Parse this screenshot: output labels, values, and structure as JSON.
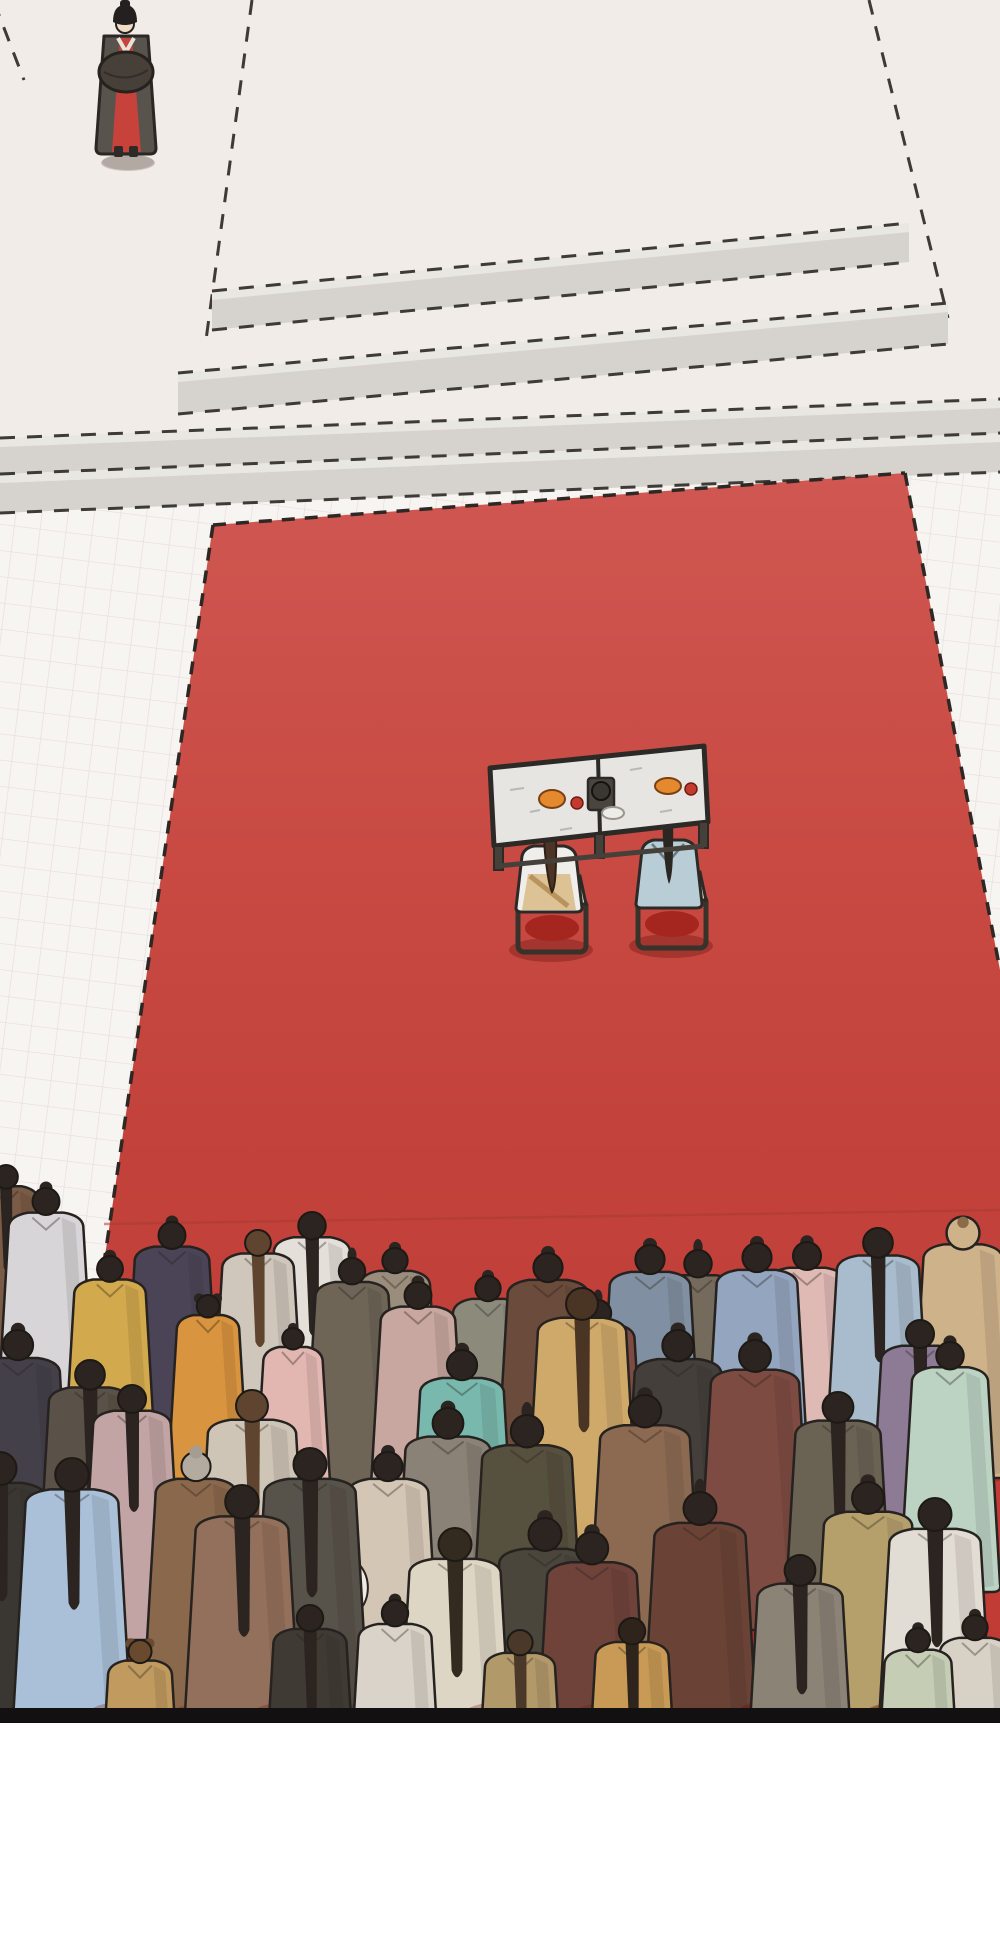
{
  "meta": {
    "type": "comic-panel",
    "description": "Overhead manhua scene: a court official in dark robe with red under-robe stands top-left beside a stepped stone dais; a long red ceremonial carpet runs down the hall to a table where two robed figures (cream and light blue) sit with dishes and a tea stand; a dense crowd of robed onlookers seen from behind fills the bottom; black panel border and white page margin below.",
    "text_content": "none"
  },
  "colors": {
    "page_bg": "#ffffff",
    "panel_border": "#121010",
    "floor_top": "#f1ece8",
    "floor_lower": "#f7f5f2",
    "tile_line": "#ded8d2",
    "step_face": "#d6d3ce",
    "step_light": "#e9e7e2",
    "dash": "#3e3a35",
    "carpet_top": "#d05752",
    "carpet_mid1": "#c84a43",
    "carpet_mid2": "#c2423b",
    "carpet_bottom": "#bf3a33",
    "carpet_edge_dash": "#2e2723",
    "carpet_shade_line": "#a93c34",
    "table_top": "#e7e5e1",
    "table_frame": "#45413a",
    "table_outline": "#2c2a26",
    "cushion": "#e9dec5",
    "seat_red": "#a5251f",
    "dish_orange": "#e5892f",
    "item_red": "#c23b2e",
    "plate": "#edece8",
    "kettle": "#3a3733",
    "bride_robe": "#f0eeea",
    "bride_sash": "#dcc294",
    "bride_strap": "#b9935c",
    "bride_hair": "#4c3526",
    "groom_robe": "#b9cdd6",
    "groom_hair": "#2c2622",
    "official_outer": "#59534d",
    "official_sleeve": "#474038",
    "official_red": "#c6423b",
    "official_hat": "#242020",
    "skin": "#f1dcc6",
    "hair_default": "#2b2420"
  },
  "scene": {
    "platform_edges": [
      "M252 0 L206 340",
      "M869 0 L948 318",
      "M-6 2 L24 80"
    ],
    "steps": [
      {
        "x1": 212,
        "y1": 300,
        "x2": 909,
        "y2": 232,
        "t": 30
      },
      {
        "x1": 178,
        "y1": 382,
        "x2": 948,
        "y2": 312,
        "t": 32
      },
      {
        "x1": 0,
        "y1": 447,
        "x2": 1000,
        "y2": 408,
        "t": 30
      },
      {
        "x1": 0,
        "y1": 483,
        "x2": 1000,
        "y2": 442,
        "t": 30
      }
    ],
    "carpet": {
      "points": "213,525 905,473 1000,970 1000,1723 36,1723",
      "border_paths": [
        "M213 525 L905 473",
        "M905 473 L1000 970",
        "M213 525 L36 1723"
      ],
      "shade_line": "M104 1224 L1000 1210"
    },
    "tile_shadows": [
      [
        128,
        163,
        27,
        8
      ],
      [
        20,
        1450,
        40,
        20
      ],
      [
        58,
        1530,
        58,
        26
      ],
      [
        30,
        1630,
        48,
        24
      ]
    ],
    "table_shadows": [
      [
        551,
        950,
        42,
        12
      ],
      [
        671,
        946,
        42,
        12
      ]
    ],
    "people": [
      {
        "x": 6,
        "y": 1165,
        "h": 215,
        "c": "#7a5b45",
        "s": "ponytail"
      },
      {
        "x": 46,
        "y": 1188,
        "h": 245,
        "c": "#d7d5d7",
        "s": "bun"
      },
      {
        "x": 172,
        "y": 1222,
        "h": 245,
        "c": "#4a4456",
        "s": "bun"
      },
      {
        "x": 110,
        "y": 1256,
        "h": 235,
        "c": "#d2a94c",
        "s": "bun"
      },
      {
        "x": 208,
        "y": 1295,
        "h": 205,
        "c": "#d8943e",
        "s": "doublebun"
      },
      {
        "x": 258,
        "y": 1230,
        "h": 235,
        "c": "#cfc7bc",
        "s": "ponytail",
        "hc": "#5f4530"
      },
      {
        "x": 312,
        "y": 1212,
        "h": 250,
        "c": "#e4dfd8",
        "s": "ponytail"
      },
      {
        "x": 293,
        "y": 1328,
        "h": 195,
        "c": "#e2b7b2",
        "s": "bun"
      },
      {
        "x": 352,
        "y": 1258,
        "h": 240,
        "c": "#6e6557",
        "s": "topknot"
      },
      {
        "x": 395,
        "y": 1248,
        "h": 230,
        "c": "#9a8d7c",
        "s": "bun"
      },
      {
        "x": 418,
        "y": 1282,
        "h": 245,
        "c": "#c7a79f",
        "s": "bun"
      },
      {
        "x": 488,
        "y": 1276,
        "h": 230,
        "c": "#8c8b7b",
        "s": "bun"
      },
      {
        "x": 548,
        "y": 1253,
        "h": 265,
        "c": "#6b4b3b",
        "s": "bun"
      },
      {
        "x": 598,
        "y": 1300,
        "h": 240,
        "c": "#7d4b42",
        "s": "topknot"
      },
      {
        "x": 650,
        "y": 1245,
        "h": 265,
        "c": "#8090a2",
        "s": "bun"
      },
      {
        "x": 698,
        "y": 1250,
        "h": 250,
        "c": "#746b5d",
        "s": "topknot"
      },
      {
        "x": 757,
        "y": 1243,
        "h": 265,
        "c": "#93a5bf",
        "s": "bun"
      },
      {
        "x": 807,
        "y": 1242,
        "h": 255,
        "c": "#dfb9b4",
        "s": "bun"
      },
      {
        "x": 878,
        "y": 1228,
        "h": 270,
        "c": "#a9bccd",
        "s": "ponytail"
      },
      {
        "x": 963,
        "y": 1218,
        "h": 260,
        "c": "#cdb28a",
        "s": "hood",
        "hc": "#8a6b4a"
      },
      {
        "x": 920,
        "y": 1320,
        "h": 255,
        "c": "#8d7a94",
        "s": "ponytail"
      },
      {
        "x": 950,
        "y": 1342,
        "h": 250,
        "c": "#bcd3c4",
        "s": "bun"
      },
      {
        "x": 18,
        "y": 1330,
        "h": 275,
        "c": "#43404a",
        "s": "bun",
        "b": 1
      },
      {
        "x": 90,
        "y": 1360,
        "h": 270,
        "c": "#5a5248",
        "s": "ponytail"
      },
      {
        "x": 132,
        "y": 1385,
        "h": 255,
        "c": "#c2a4a4",
        "s": "ponytail"
      },
      {
        "x": 196,
        "y": 1452,
        "h": 265,
        "c": "#8a684c",
        "s": "grayhair"
      },
      {
        "x": 252,
        "y": 1390,
        "h": 290,
        "c": "#cfc5b6",
        "s": "ponytail",
        "hc": "#5f4530"
      },
      {
        "x": 310,
        "y": 1448,
        "h": 300,
        "c": "#57524a",
        "s": "ponytail"
      },
      {
        "x": 388,
        "y": 1452,
        "h": 265,
        "c": "#d3c6b4",
        "s": "bun",
        "b": 1
      },
      {
        "x": 448,
        "y": 1408,
        "h": 280,
        "c": "#8a8276",
        "s": "bun"
      },
      {
        "x": 462,
        "y": 1350,
        "h": 275,
        "c": "#79b8ad",
        "s": "bun"
      },
      {
        "x": 527,
        "y": 1415,
        "h": 295,
        "c": "#56503f",
        "s": "topknot"
      },
      {
        "x": 582,
        "y": 1288,
        "h": 290,
        "c": "#cfa969",
        "s": "ponytail",
        "hc": "#4a3423"
      },
      {
        "x": 645,
        "y": 1395,
        "h": 295,
        "c": "#8c6a52",
        "s": "bun"
      },
      {
        "x": 678,
        "y": 1330,
        "h": 285,
        "c": "#443f3a",
        "s": "bun"
      },
      {
        "x": 755,
        "y": 1340,
        "h": 290,
        "c": "#7d4b42",
        "s": "bun"
      },
      {
        "x": 838,
        "y": 1392,
        "h": 280,
        "c": "#6a6354",
        "s": "ponytail"
      },
      {
        "x": 0,
        "y": 1452,
        "h": 300,
        "c": "#3a3733",
        "s": "ponytail"
      },
      {
        "x": 72,
        "y": 1458,
        "h": 305,
        "c": "#a9c0d8",
        "s": "ponytail"
      },
      {
        "x": 140,
        "y": 1640,
        "h": 210,
        "c": "#c09a5e",
        "s": "doublebun",
        "hc": "#6a4a2e"
      },
      {
        "x": 242,
        "y": 1485,
        "h": 305,
        "c": "#93705b",
        "s": "ponytail"
      },
      {
        "x": 310,
        "y": 1605,
        "h": 240,
        "c": "#3f3a34",
        "s": "ponytail"
      },
      {
        "x": 395,
        "y": 1600,
        "h": 240,
        "c": "#d9d3c9",
        "s": "bun"
      },
      {
        "x": 455,
        "y": 1528,
        "h": 300,
        "c": "#ded6c5",
        "s": "ponytail",
        "hc": "#332a20"
      },
      {
        "x": 520,
        "y": 1630,
        "h": 230,
        "c": "#b2996a",
        "s": "ponytail",
        "hc": "#4a3828"
      },
      {
        "x": 545,
        "y": 1518,
        "h": 300,
        "c": "#4a463c",
        "s": "bun"
      },
      {
        "x": 592,
        "y": 1532,
        "h": 295,
        "c": "#6f433a",
        "s": "bun"
      },
      {
        "x": 632,
        "y": 1618,
        "h": 240,
        "c": "#c89a55",
        "s": "ponytail",
        "hc": "#2e241c"
      },
      {
        "x": 700,
        "y": 1492,
        "h": 300,
        "c": "#6a4336",
        "s": "topknot"
      },
      {
        "x": 770,
        "y": 1688,
        "h": 120,
        "c": "#5a5248",
        "s": "bun"
      },
      {
        "x": 800,
        "y": 1555,
        "h": 280,
        "c": "#8b8375",
        "s": "ponytail"
      },
      {
        "x": 868,
        "y": 1482,
        "h": 290,
        "c": "#b5a06c",
        "s": "bun"
      },
      {
        "x": 935,
        "y": 1498,
        "h": 300,
        "c": "#e2ddd4",
        "s": "ponytail"
      },
      {
        "x": 975,
        "y": 1615,
        "h": 230,
        "c": "#d8d2c6",
        "s": "bun"
      },
      {
        "x": 918,
        "y": 1628,
        "h": 220,
        "c": "#c5cdb4",
        "s": "bun"
      },
      {
        "x": 485,
        "y": 1660,
        "h": 140,
        "c": "#44403a",
        "s": "bun"
      }
    ]
  }
}
